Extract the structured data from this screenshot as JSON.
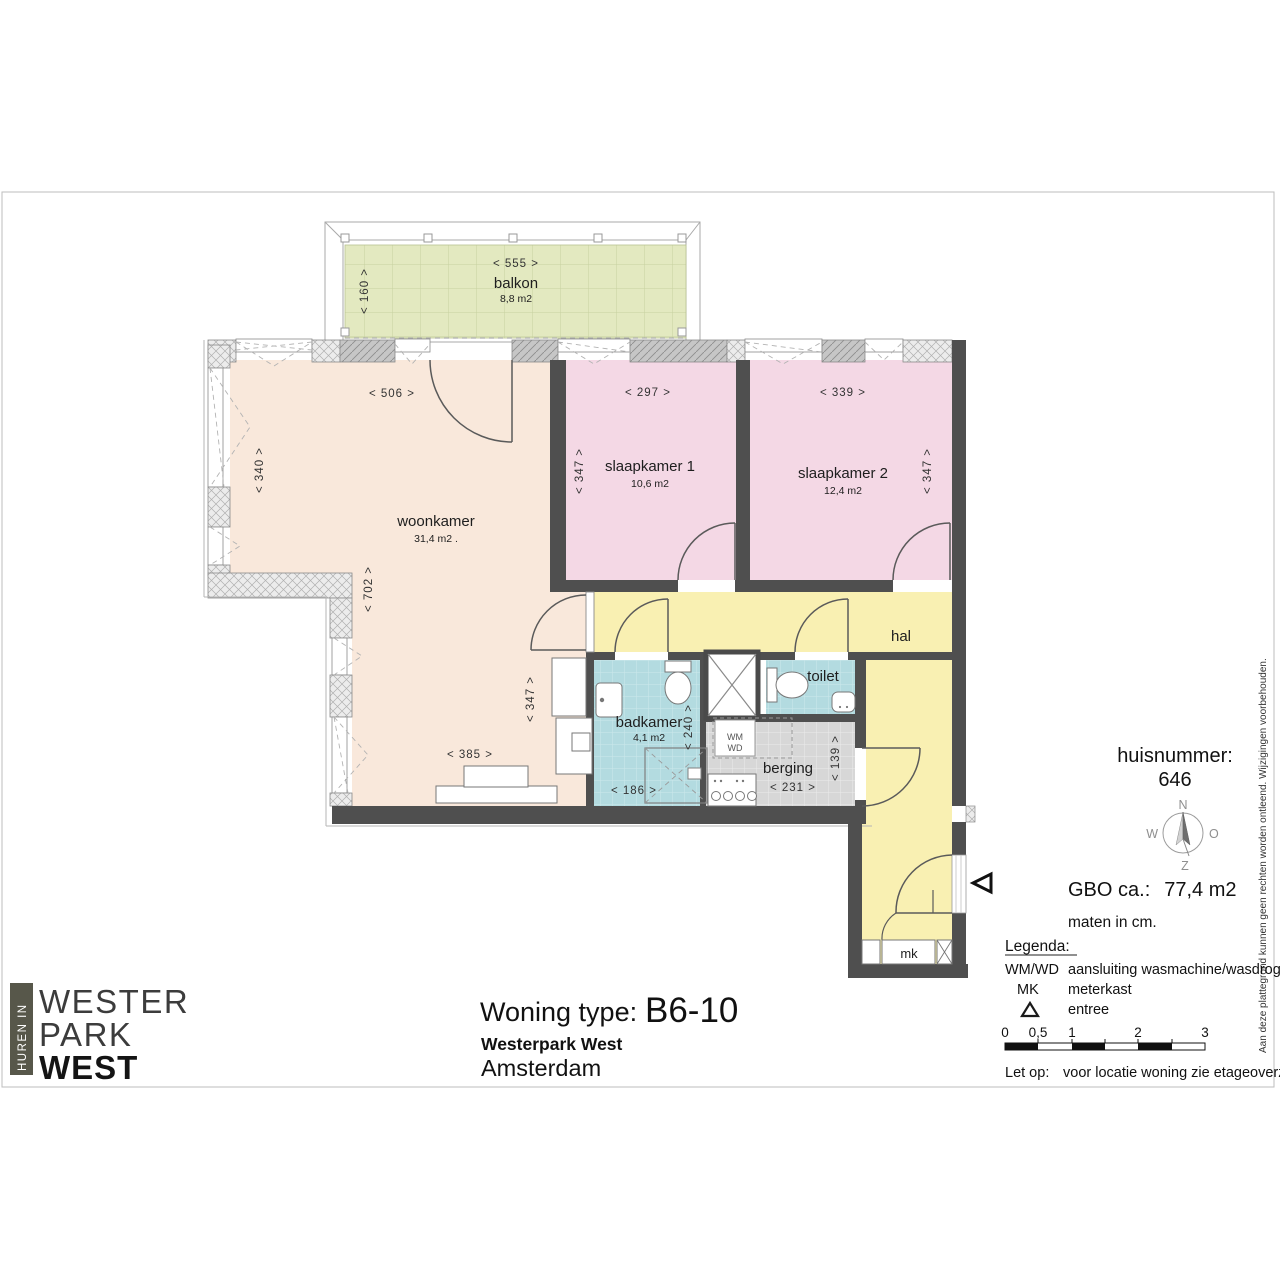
{
  "page": {
    "disclaimer": "Aan deze plattegrond kunnen geen rechten worden ontleend. Wijzigingen voorbehouden."
  },
  "logo": {
    "vertical": "HUREN IN",
    "line1": "WESTER",
    "line2": "PARK",
    "line3": "WEST",
    "bar_color": "#57574a"
  },
  "title_block": {
    "label": "Woning type:",
    "code": "B6-10",
    "project": "Westerpark West",
    "city": "Amsterdam"
  },
  "info": {
    "huisnummer_label": "huisnummer:",
    "huisnummer_value": "646",
    "compass": {
      "n": "N",
      "o": "O",
      "z": "Z",
      "w": "W"
    },
    "gbo_label": "GBO ca.:",
    "gbo_value": "77,4 m2",
    "maten": "maten in cm.",
    "legend_title": "Legenda:",
    "legend": [
      {
        "symbol": "WM/WD",
        "desc": "aansluiting wasmachine/wasdroger"
      },
      {
        "symbol": "MK",
        "desc": "meterkast"
      },
      {
        "symbol_icon": "triangle-up-icon",
        "desc": "entree"
      }
    ],
    "scale_labels": [
      "0",
      "0,5",
      "1",
      "2",
      "3"
    ],
    "note_label": "Let op:",
    "note_text": "voor locatie woning zie etageoverzicht."
  },
  "plan": {
    "rooms": {
      "balkon": {
        "name": "balkon",
        "area": "8,8 m2"
      },
      "woonkamer": {
        "name": "woonkamer",
        "area": "31,4 m2 ."
      },
      "slaapkamer1": {
        "name": "slaapkamer 1",
        "area": "10,6 m2"
      },
      "slaapkamer2": {
        "name": "slaapkamer 2",
        "area": "12,4 m2"
      },
      "badkamer": {
        "name": "badkamer",
        "area": "4,1 m2"
      },
      "toilet": {
        "name": "toilet"
      },
      "berging": {
        "name": "berging"
      },
      "hal": {
        "name": "hal"
      },
      "mk": {
        "name": "mk"
      }
    },
    "fixtures": {
      "wm": "WM",
      "wd": "WD"
    },
    "dims": {
      "balkon_w": "<  555  >",
      "balkon_d": "<  160  >",
      "woon_w": "<  506  >",
      "woon_d": "<  340  >",
      "woon_d2": "<  702  >",
      "woon_d3": "<  347  >",
      "woon_w2": "<  385  >",
      "sk1_w": "<  297  >",
      "sk1_d": "<  347  >",
      "sk2_w": "<  339  >",
      "sk2_d": "<  347  >",
      "bad_w": "<  186  >",
      "bad_d": "<  240  >",
      "berg_w": "<  231  >",
      "berg_d": "<  139  >"
    },
    "colors": {
      "woonkamer": "#f9e8db",
      "slaapkamer": "#f4d8e5",
      "hal": "#f9f0b2",
      "sanitair": "#b3dbe0",
      "berging": "#d7d7d7",
      "balkon": "#e3e9c0",
      "wall": "#4f4f4f"
    }
  }
}
